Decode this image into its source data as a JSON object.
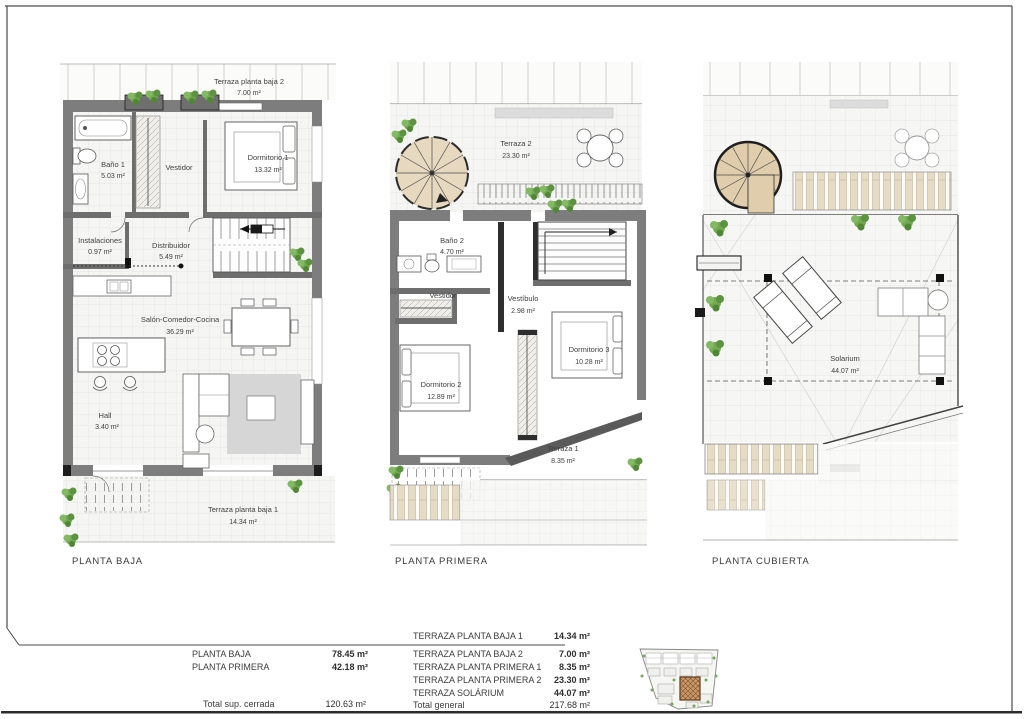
{
  "plans": [
    {
      "label": "PLANTA BAJA",
      "rooms": [
        {
          "name": "Terraza planta baja 2",
          "area": "7.00 m²"
        },
        {
          "name": "Baño 1",
          "area": "5.03 m²"
        },
        {
          "name": "Vestidor",
          "area": ""
        },
        {
          "name": "Dormitorio 1",
          "area": "13.32 m²"
        },
        {
          "name": "Instalaciones",
          "area": "0.97 m²"
        },
        {
          "name": "Distribuidor",
          "area": "5.49 m²"
        },
        {
          "name": "Salón-Comedor-Cocina",
          "area": "36.29 m²"
        },
        {
          "name": "Hall",
          "area": "3.40 m²"
        },
        {
          "name": "Terraza planta baja 1",
          "area": "14.34 m²"
        }
      ]
    },
    {
      "label": "PLANTA PRIMERA",
      "rooms": [
        {
          "name": "Terraza 2",
          "area": "23.30 m²"
        },
        {
          "name": "Baño 2",
          "area": "4.70 m²"
        },
        {
          "name": "Vestidor",
          "area": ""
        },
        {
          "name": "Vestíbulo",
          "area": "2.98 m²"
        },
        {
          "name": "Dormitorio 2",
          "area": "12.89 m²"
        },
        {
          "name": "Dormitorio 3",
          "area": "10.28 m²"
        },
        {
          "name": "Terraza 1",
          "area": "8.35 m²"
        }
      ]
    },
    {
      "label": "PLANTA CUBIERTA",
      "rooms": [
        {
          "name": "Solarium",
          "area": "44.07 m²"
        }
      ]
    }
  ],
  "summary": {
    "left_rows": [
      {
        "label": "PLANTA BAJA",
        "value": "78.45 m²"
      },
      {
        "label": "PLANTA PRIMERA",
        "value": "42.18 m²"
      }
    ],
    "left_total": {
      "label": "Total sup. cerrada",
      "value": "120.63 m²"
    },
    "right_rows": [
      {
        "label": "TERRAZA PLANTA BAJA 1",
        "value": "14.34 m²"
      },
      {
        "label": "TERRAZA PLANTA BAJA 2",
        "value": "7.00 m²"
      },
      {
        "label": "TERRAZA PLANTA PRIMERA 1",
        "value": "8.35 m²"
      },
      {
        "label": "TERRAZA PLANTA PRIMERA 2",
        "value": "23.30 m²"
      },
      {
        "label": "TERRAZA SOLÁRIUM",
        "value": "44.07 m²"
      }
    ],
    "right_total": {
      "label": "Total general",
      "value": "217.68 m²"
    }
  },
  "colors": {
    "wall_gray": "#7d7d7d",
    "dark_wall": "#2e2e2e",
    "tile_bg": "#f5f5f3",
    "wood_tan": "#e0cdab",
    "plant_green": "#72a84f",
    "site_highlight": "#c9996b"
  }
}
